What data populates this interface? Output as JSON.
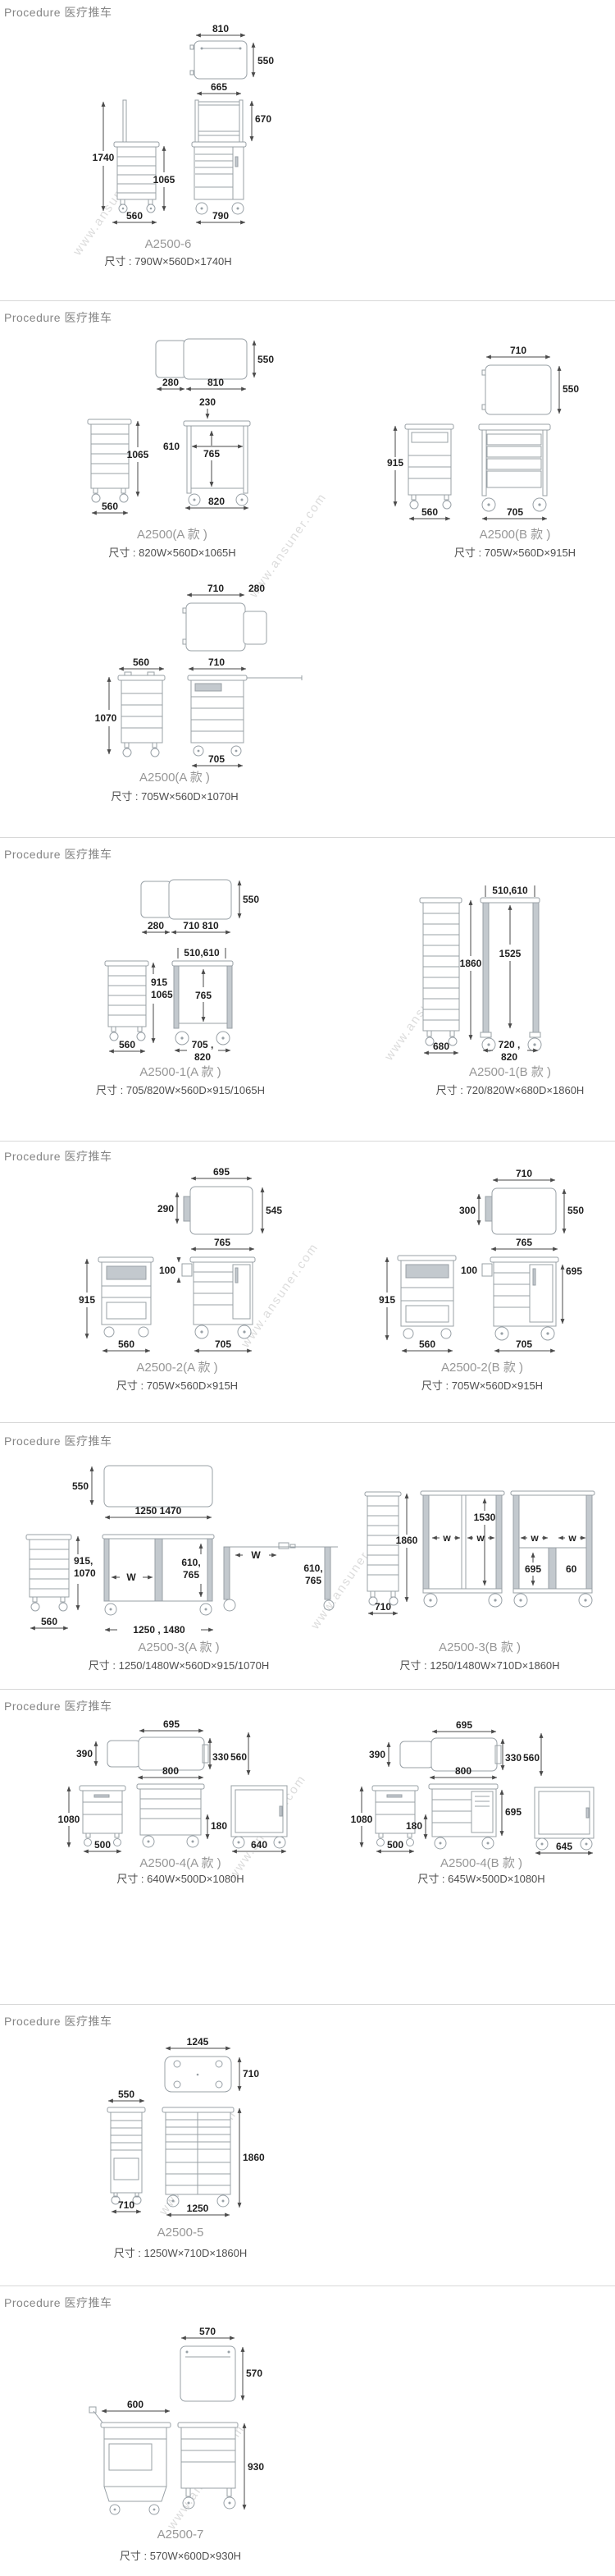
{
  "page": {
    "section_header": "Procedure 医疗推车",
    "watermark": "www.ansuner.com"
  },
  "products": {
    "a2500_6": {
      "model": "A2500-6",
      "size": "尺寸 : 790W×560D×1740H",
      "dims": {
        "top_w": "810",
        "top_d": "550",
        "rail_w": "665",
        "rail_h": "670",
        "total_h": "1740",
        "body_h": "1065",
        "side_w": "560",
        "front_w": "790"
      }
    },
    "a2500_a": {
      "model": "A2500(A 款 )",
      "size": "尺寸 : 820W×560D×1065H",
      "dims": {
        "ext_d": "280",
        "top_w": "810",
        "top_d": "550",
        "gap_w": "230",
        "inner_w": "610",
        "open_h": "765",
        "body_h": "1065",
        "side_w": "560",
        "front_w": "820"
      }
    },
    "a2500_b": {
      "model": "A2500(B 款 )",
      "size": "尺寸 : 705W×560D×915H",
      "dims": {
        "top_w": "710",
        "top_d": "550",
        "body_h": "915",
        "side_w": "560",
        "front_w": "705"
      }
    },
    "a2500_a2": {
      "model": "A2500(A 款 )",
      "size": "尺寸 : 705W×560D×1070H",
      "dims": {
        "top_w": "710",
        "ext_d": "280",
        "side_w": "560",
        "body_h": "1070",
        "front_top_w": "710",
        "front_w": "705"
      }
    },
    "a2500_1a": {
      "model": "A2500-1(A 款 )",
      "size": "尺寸 : 705/820W×560D×915/1065H",
      "dims": {
        "ext_d": "280",
        "top_w": "710 810",
        "top_d": "550",
        "rail_w": "510,610",
        "body_h1": "915",
        "body_h2": "1065",
        "open_h": "765",
        "side_w": "560",
        "front_w1": "705 ,",
        "front_w2": "820"
      }
    },
    "a2500_1b": {
      "model": "A2500-1(B 款 )",
      "size": "尺寸 : 720/820W×680D×1860H",
      "dims": {
        "rail_w": "510,610",
        "total_h": "1860",
        "inner_h": "1525",
        "side_w": "680",
        "front_w1": "720 ,",
        "front_w2": "820"
      }
    },
    "a2500_2a": {
      "model": "A2500-2(A 款 )",
      "size": "尺寸 : 705W×560D×915H",
      "dims": {
        "top_w": "695",
        "hatch_h": "290",
        "top_d": "545",
        "front_w": "765",
        "bin_h": "100",
        "body_h": "915",
        "side_w": "560",
        "front_bottom_w": "705"
      }
    },
    "a2500_2b": {
      "model": "A2500-2(B 款 )",
      "size": "尺寸 : 705W×560D×915H",
      "dims": {
        "top_w": "710",
        "hatch_h": "300",
        "top_d": "550",
        "front_w": "765",
        "bin_h": "100",
        "door_h": "695",
        "body_h": "915",
        "side_w": "560",
        "front_bottom_w": "705"
      }
    },
    "a2500_3a": {
      "model": "A2500-3(A 款 )",
      "size": "尺寸 : 1250/1480W×560D×915/1070H",
      "dims": {
        "top_d": "550",
        "top_w": "1250 1470",
        "body_h1": "915,",
        "body_h2": "1070",
        "w_label": "W",
        "inner_h1": "610,",
        "inner_h2": "765",
        "side_w": "560",
        "front_w": "1250 , 1480",
        "w2_label": "W",
        "inner2_h1": "610,",
        "inner2_h2": "765"
      }
    },
    "a2500_3b": {
      "model": "A2500-3(B 款 )",
      "size": "尺寸 : 1250/1480W×710D×1860H",
      "dims": {
        "total_h": "1860",
        "side_w": "710",
        "inner_h": "1530",
        "w1": "w",
        "w2": "w",
        "w3": "w",
        "w4": "w",
        "shelf_h": "695",
        "post_w": "60"
      }
    },
    "a2500_4a": {
      "model": "A2500-4(A 款 )",
      "size": "尺寸 : 640W×500D×1080H",
      "dims": {
        "top_w": "695",
        "seat_d": "390",
        "back_h": "330",
        "top_d": "560",
        "front_w": "800",
        "gap_h": "180",
        "total_h": "1080",
        "side_w": "500",
        "cab_w": "640"
      }
    },
    "a2500_4b": {
      "model": "A2500-4(B 款 )",
      "size": "尺寸 : 645W×500D×1080H",
      "dims": {
        "top_w": "695",
        "seat_d": "390",
        "back_h": "330",
        "top_d": "560",
        "front_w": "800",
        "gap_h": "180",
        "door_h": "695",
        "total_h": "1080",
        "side_w": "500",
        "cab_w": "645"
      }
    },
    "a2500_5": {
      "model": "A2500-5",
      "size": "尺寸 : 1250W×710D×1860H",
      "dims": {
        "top_w": "1245",
        "top_d": "710",
        "side_top_w": "550",
        "side_w": "710",
        "total_h": "1860",
        "front_w": "1250"
      }
    },
    "a2500_7": {
      "model": "A2500-7",
      "size": "尺寸 : 570W×600D×930H",
      "dims": {
        "top_w": "570",
        "top_d": "570",
        "side_w": "600",
        "total_h": "930"
      }
    }
  }
}
